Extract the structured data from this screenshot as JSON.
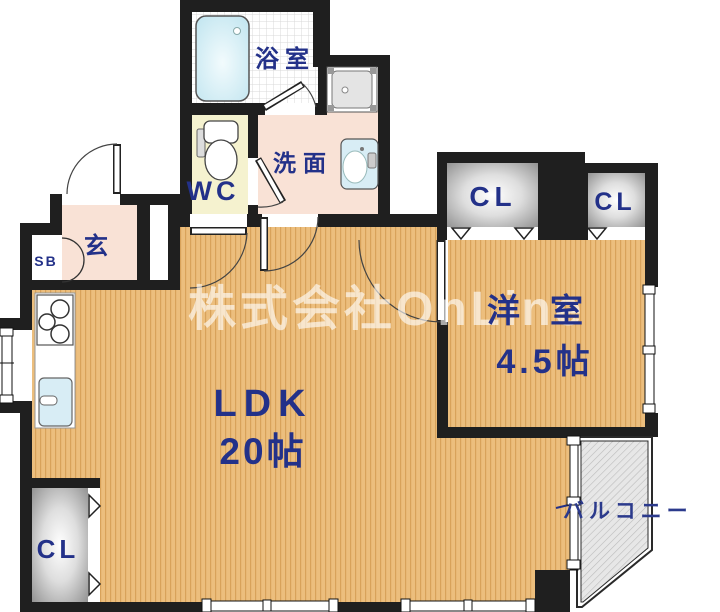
{
  "watermark": "株式会社OnLine",
  "rooms": {
    "bathroom": {
      "label": "浴室"
    },
    "washroom": {
      "label": "洗面"
    },
    "toilet": {
      "label": "WC"
    },
    "entrance": {
      "label": "玄"
    },
    "shoe_box": {
      "label": "SB"
    },
    "ldk": {
      "label": "LDK",
      "size": "20帖"
    },
    "western_room": {
      "label": "洋室",
      "size": "4.5帖"
    },
    "closet_upper_left": {
      "label": "CL"
    },
    "closet_upper_right": {
      "label": "CL"
    },
    "closet_bottom": {
      "label": "CL"
    },
    "balcony": {
      "label": "バルコニー"
    }
  },
  "fixtures": [
    "bathtub-icon",
    "washing-machine-pan-icon",
    "toilet-icon",
    "washbasin-icon",
    "stove-icon",
    "kitchen-sink-icon"
  ],
  "colors": {
    "wall": "#1f1f1f",
    "label": "#233189",
    "floor_wood": "#ecbe7d",
    "floor_wood_stripe": "#d8a25a",
    "floor_pink": "#f9e2d6",
    "floor_yellow": "#f5f2cf",
    "bathtub": "#cdeaf3",
    "balcony": "#e7e7e7",
    "watermark": "rgba(255,255,255,0.62)"
  }
}
